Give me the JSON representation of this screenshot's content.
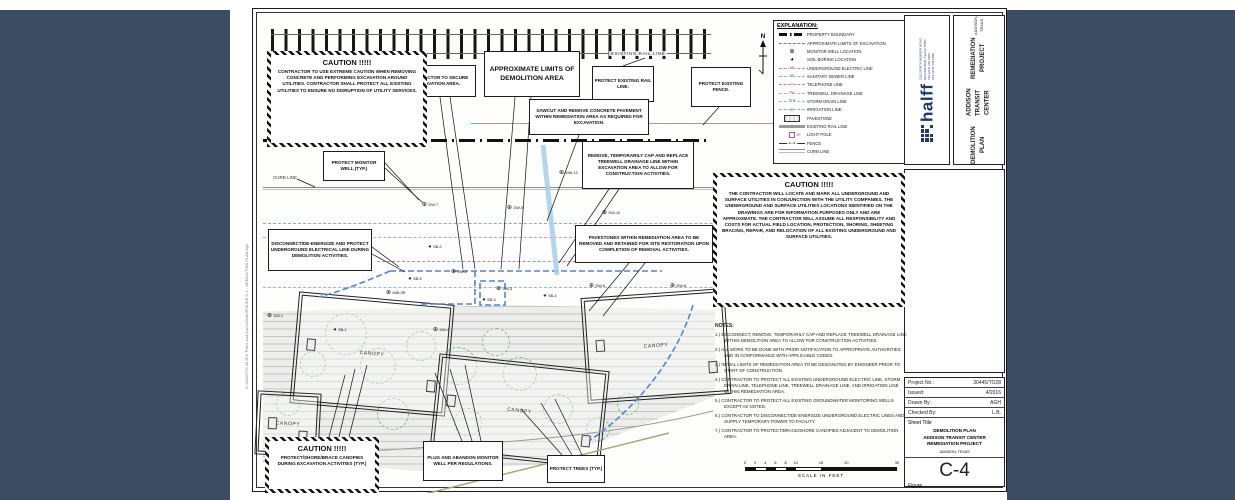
{
  "sheet": {
    "colors": {
      "backdrop": "#3c4d63",
      "brand_navy": "#1d3a6e",
      "excavation_blue": "#4f86d8",
      "electric_magenta": "#c77ac7",
      "sewer_green": "#86bb86",
      "storm_cyan": "#6fc9da",
      "telephone_red": "#d08080",
      "fence_pink": "#c98b8b",
      "rail_gray": "#9a9a9a"
    },
    "labels": {
      "existing_rail_line": "EXISTING RAIL LINE",
      "curb_line": "CURB LINE",
      "north": "N",
      "file_path": "X:\\30445\\TO 28 ATC Plans and Specs\\Draft\\FIGURE C-4 - DEMOLITION PLAN.dgn"
    },
    "explanation": {
      "title": "EXPLANATION:",
      "items": [
        {
          "type": "property",
          "label": "PROPERTY BOUNDARY"
        },
        {
          "type": "excav",
          "label": "APPROXIMATE LIMITS OF EXCAVATION"
        },
        {
          "type": "mw",
          "label": "MONITOR WELL LOCATION"
        },
        {
          "type": "sb",
          "label": "SOIL BORING LOCATION"
        },
        {
          "type": "ue",
          "tag": "UE",
          "label": "UNDERGROUND ELECTRIC LINE"
        },
        {
          "type": "ss",
          "tag": "SS",
          "label": "SANITARY SEWER LINE"
        },
        {
          "type": "tel",
          "tag": "T",
          "label": "TELEPHONE LINE"
        },
        {
          "type": "tw",
          "tag": "TW",
          "label": "TREEWELL DRAINAGE LINE"
        },
        {
          "type": "stm",
          "tag": "STM",
          "label": "STORM DRAIN LINE"
        },
        {
          "type": "irr",
          "tag": "IR",
          "label": "IRRIGATION LINE"
        },
        {
          "type": "pave",
          "label": "PAVESTONE"
        },
        {
          "type": "rail",
          "label": "EXISTING RAIL LINE"
        },
        {
          "type": "pole",
          "label": "LIGHT POLE"
        },
        {
          "type": "fence",
          "label": "FENCE"
        },
        {
          "type": "curb",
          "label": "CURB LINE"
        }
      ]
    },
    "cautions": {
      "top_left": {
        "title": "CAUTION  !!!!!",
        "body": "CONTRACTOR TO USE EXTREME CAUTION WHEN REMOVING CONCRETE AND PERFORMING EXCAVATION AROUND UTILITIES. CONTRACTOR SHALL PROTECT ALL EXISTING UTILITIES TO ENSURE NO DISRUPTION OF UTILITY SERVICES."
      },
      "right": {
        "title": "CAUTION  !!!!!",
        "body": "THE CONTRACTOR WILL LOCATE AND MARK ALL UNDERGROUND AND SURFACE UTILITIES IN CONJUNCTION WITH THE UTILITY COMPANIES. THE UNDERGROUND AND SURFACE UTILITIES LOCATIONS IDENTIFIED ON THE DRAWINGS ARE FOR INFORMATION PURPOSES ONLY AND ARE APPROXIMATE.  THE CONTRACTOR WILL ASSUME ALL RESPONSIBILITY AND COSTS FOR ACTUAL FIELD LOCATION, PROTECTION, SHORING, SHEETING BRACING, REPAIR, AND RELOCATION OF ALL EXISTING UNDERGROUND AND SURFACE UTILITIES."
      },
      "bottom_left": {
        "title": "CAUTION  !!!!!",
        "body": "PROTECT/SHORE/BRACE CANOPIES DURING EXCAVATION ACTIVITIES (TYP.)"
      }
    },
    "callouts": [
      {
        "id": "secure-excavation",
        "text": "CONTRACTOR TO SECURE EXCAVATION AREA.",
        "x": 143,
        "y": 52,
        "w": 76,
        "h": 32
      },
      {
        "id": "demolition-limits",
        "text": "APPROXIMATE LIMITS OF DEMOLITION AREA",
        "x": 227,
        "y": 38,
        "w": 96,
        "h": 46,
        "big": true
      },
      {
        "id": "protect-rail",
        "text": "PROTECT EXISTING RAIL LINE.",
        "x": 335,
        "y": 53,
        "w": 62,
        "h": 36
      },
      {
        "id": "protect-fence",
        "text": "PROTECT EXISTING FENCE.",
        "x": 434,
        "y": 54,
        "w": 60,
        "h": 40
      },
      {
        "id": "sawcut",
        "text": "SAWCUT AND REMOVE CONCRETE PAVEMENT WITHIN REMEDIATION AREA AS REQUIRED FOR EXCAVATION.",
        "x": 272,
        "y": 86,
        "w": 120,
        "h": 36
      },
      {
        "id": "remove-treewell",
        "text": "REMOVE, TEMPORARILY CAP AND REPLACE TREEWELL DRAINAGE LINE WITHIN EXCAVATION AREA TO ALLOW FOR CONSTRUCTION ACTIVITIES.",
        "x": 325,
        "y": 128,
        "w": 112,
        "h": 48
      },
      {
        "id": "protect-monitor-well",
        "text": "PROTECT MONITOR WELL (TYP.)",
        "x": 66,
        "y": 138,
        "w": 62,
        "h": 30
      },
      {
        "id": "disconnect-electric",
        "text": "DISCONNECT/DE-ENERGIZE AND PROTECT UNDERGROUND ELECTRICAL LINE DURING DEMOLITION ACTIVITIES.",
        "x": 11,
        "y": 216,
        "w": 104,
        "h": 42
      },
      {
        "id": "pavestones",
        "text": "PAVESTONES WITHIN REMEDIATION AREA TO BE REMOVED AND RETAINED FOR SITE RESTORATION UPON COMPLETION OF REMOVAL ACTIVITIES.",
        "x": 318,
        "y": 212,
        "w": 138,
        "h": 38
      },
      {
        "id": "plug-abandon",
        "text": "PLUG AND ABANDON MONITOR WELL PER REGULATIONS.",
        "x": 166,
        "y": 428,
        "w": 80,
        "h": 40
      },
      {
        "id": "protect-trees",
        "text": "PROTECT TREES (TYP.)",
        "x": 290,
        "y": 442,
        "w": 58,
        "h": 28
      }
    ],
    "notes": {
      "title": "NOTES:",
      "items": [
        "1.)  DISCONNECT, REMOVE, TEMPORARILY CAP AND REPLACE TREEWELL DRAINAGE LINE WITHIN DEMOLITION AREA TO ALLOW FOR CONSTRUCTION ACTIVITIES.",
        "2.)  ALL WORK TO BE DONE WITH PRIOR NOTIFICATION TO APPROPRIATE AUTHORITIES AND IN CONFORMANCE WITH APPLICABLE CODES.",
        "3.)  INITIAL LIMITS OF REMEDIATION AREA TO BE DESIGNATED BY ENGINEER PRIOR TO START OF CONSTRUCTION.",
        "4.)  CONTRACTOR TO PROTECT ALL EXISTING UNDERGROUND ELECTRIC LINE, STORM DRAIN LINE, TELEPHONE LINE, TREEWELL DRAINAGE LINE, AND IRRIGATION LINE WITHIN REMEDIATION AREA.",
        "5.)  CONTRACTOR TO PROTECT ALL EXISTING GROUNDWATER MONITORING WELLS EXCEPT AS NOTED.",
        "6.)  CONTRACTOR TO DISCONNECT/DE-ENERGIZE UNDERGROUND ELECTRIC LINES AND SUPPLY TEMPORARY POWER TO FACILITY.",
        "7.)  CONTRACTOR TO PROTECT/BRACE/SHORE CANOPIES ADJACENT TO DEMOLITION AREA."
      ]
    },
    "wells": [
      {
        "label": "MW-12",
        "type": "mw",
        "x": 302,
        "y": 157
      },
      {
        "label": "DW-7",
        "type": "mw",
        "x": 165,
        "y": 189
      },
      {
        "label": "DW-9",
        "type": "mw",
        "x": 250,
        "y": 192
      },
      {
        "label": "DW-10",
        "type": "mw",
        "x": 345,
        "y": 197
      },
      {
        "label": "SB-2",
        "type": "sb",
        "x": 171,
        "y": 231
      },
      {
        "label": "DW-2",
        "type": "mw",
        "x": 194,
        "y": 256
      },
      {
        "label": "SB-5",
        "type": "sb",
        "x": 151,
        "y": 263
      },
      {
        "label": "DW-3",
        "type": "mw",
        "x": 239,
        "y": 273
      },
      {
        "label": "SB-3",
        "type": "sb",
        "x": 225,
        "y": 284
      },
      {
        "label": "SB-4",
        "type": "sb",
        "x": 286,
        "y": 280
      },
      {
        "label": "DW-6",
        "type": "mw",
        "x": 332,
        "y": 270
      },
      {
        "label": "DW-8",
        "type": "mw",
        "x": 413,
        "y": 270
      },
      {
        "label": "MW-3R",
        "type": "mw",
        "x": 129,
        "y": 277
      },
      {
        "label": "SB-1",
        "type": "sb",
        "x": 76,
        "y": 314
      },
      {
        "label": "DW-4",
        "type": "mw",
        "x": 176,
        "y": 314
      },
      {
        "label": "DW-1",
        "type": "mw",
        "x": 10,
        "y": 300
      }
    ],
    "plan": {
      "canopy_label": "CANOPY",
      "canopies": [
        {
          "x": 40,
          "y": 288,
          "w": 150,
          "h": 106,
          "rot": 5
        },
        {
          "x": 330,
          "y": 283,
          "w": 138,
          "h": 100,
          "rot": -4
        },
        {
          "x": 180,
          "y": 352,
          "w": 165,
          "h": 92,
          "rot": 6
        },
        {
          "x": 2,
          "y": 382,
          "w": 58,
          "h": 58,
          "rot": 3
        }
      ],
      "trees": [
        {
          "x": 88,
          "y": 320,
          "r": 20
        },
        {
          "x": 120,
          "y": 352,
          "r": 17
        },
        {
          "x": 163,
          "y": 332,
          "r": 14
        },
        {
          "x": 200,
          "y": 352,
          "r": 18
        },
        {
          "x": 238,
          "y": 328,
          "r": 13
        },
        {
          "x": 262,
          "y": 360,
          "r": 16
        },
        {
          "x": 135,
          "y": 400,
          "r": 15
        },
        {
          "x": 210,
          "y": 408,
          "r": 13
        },
        {
          "x": 300,
          "y": 395,
          "r": 14
        },
        {
          "x": 340,
          "y": 415,
          "r": 11
        },
        {
          "x": 370,
          "y": 390,
          "r": 10
        },
        {
          "x": 55,
          "y": 350,
          "r": 12
        },
        {
          "x": 30,
          "y": 390,
          "r": 11
        }
      ]
    },
    "scale_bar": {
      "max": 30,
      "ticks": [
        "0",
        "2",
        "4",
        "6",
        "8",
        "10",
        "15",
        "20",
        "30"
      ],
      "tick_values": [
        0,
        2,
        4,
        6,
        8,
        10,
        15,
        20,
        30
      ],
      "filled_segments": [
        [
          0,
          2
        ],
        [
          4,
          6
        ],
        [
          8,
          10
        ],
        [
          15,
          30
        ]
      ],
      "label": "SCALE  IN  FEET"
    },
    "title_block": {
      "logo_text": "halff",
      "logo_address_lines": [
        "1201 NORTH BOWSER ROAD",
        "RICHARDSON, TEXAS 75081",
        "TEL (214) 346-6200",
        "FAX (214) 739-0095"
      ],
      "project_title_lines": [
        "DEMOLITION PLAN",
        "ADDISON TRANSIT CENTER",
        "REMEDIATION PROJECT"
      ],
      "project_location": "ADDISON, TEXAS",
      "info_rows": [
        {
          "label": "Project No.:",
          "value": "30445/TO28"
        },
        {
          "label": "Issued:",
          "value": "4/2016"
        },
        {
          "label": "Drawn By:",
          "value": "AGH"
        },
        {
          "label": "Checked By:",
          "value": "L.B."
        }
      ],
      "sheet_title_label": "Sheet Title",
      "sheet_title_lines": [
        "DEMOLITION PLAN",
        "ADDISON TRANSIT CENTER",
        "REMEDIATION PROJECT"
      ],
      "sheet_location": "ADDISON, TEXAS",
      "sheet_number": "C-4",
      "figure_label": "Figure"
    }
  }
}
